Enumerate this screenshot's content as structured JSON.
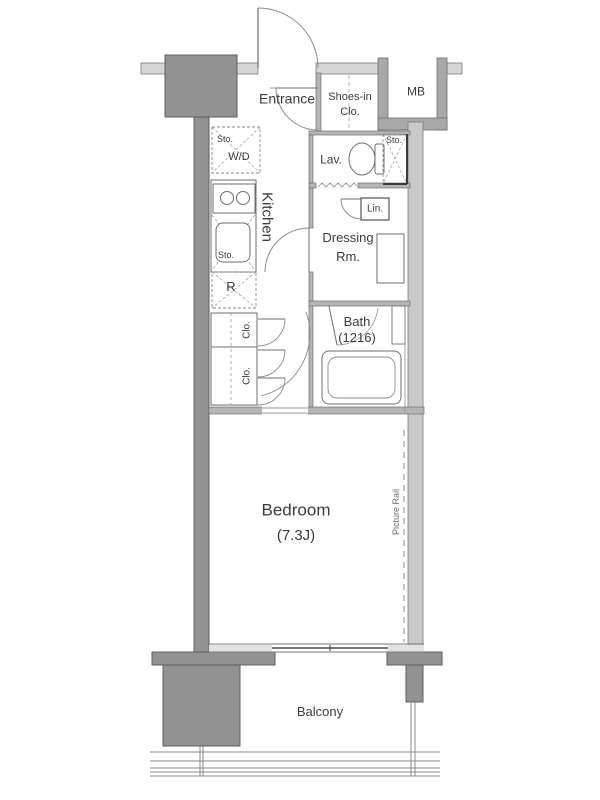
{
  "title": "Apartment floor plan",
  "labels": {
    "entrance": "Entrance",
    "shoes_closet_line1": "Shoes-in",
    "shoes_closet_line2": "Clo.",
    "meter_box": "MB",
    "lavatory": "Lav.",
    "lav_storage": "Sto.",
    "linen": "Lin.",
    "dressing_line1": "Dressing",
    "dressing_line2": "Rm.",
    "bath_line1": "Bath",
    "bath_line2": "(1216)",
    "kitchen": "Kitchen",
    "wd_storage": "Sto.",
    "washer_dryer": "W/D",
    "kitchen_storage": "Sto.",
    "refrigerator": "R",
    "closet_upper": "Clo.",
    "closet_lower": "Clo.",
    "bedroom_line1": "Bedroom",
    "bedroom_line2": "(7.3J)",
    "picture_rail": "Picture Rail",
    "balcony": "Balcony"
  },
  "colors": {
    "structure": "#929292",
    "structure_edge": "#5e5e5e",
    "wall_light": "#d6d6d6",
    "wall_mid": "#a8a8a8",
    "line": "#6e6e6e",
    "text": "#3b3b3b"
  }
}
